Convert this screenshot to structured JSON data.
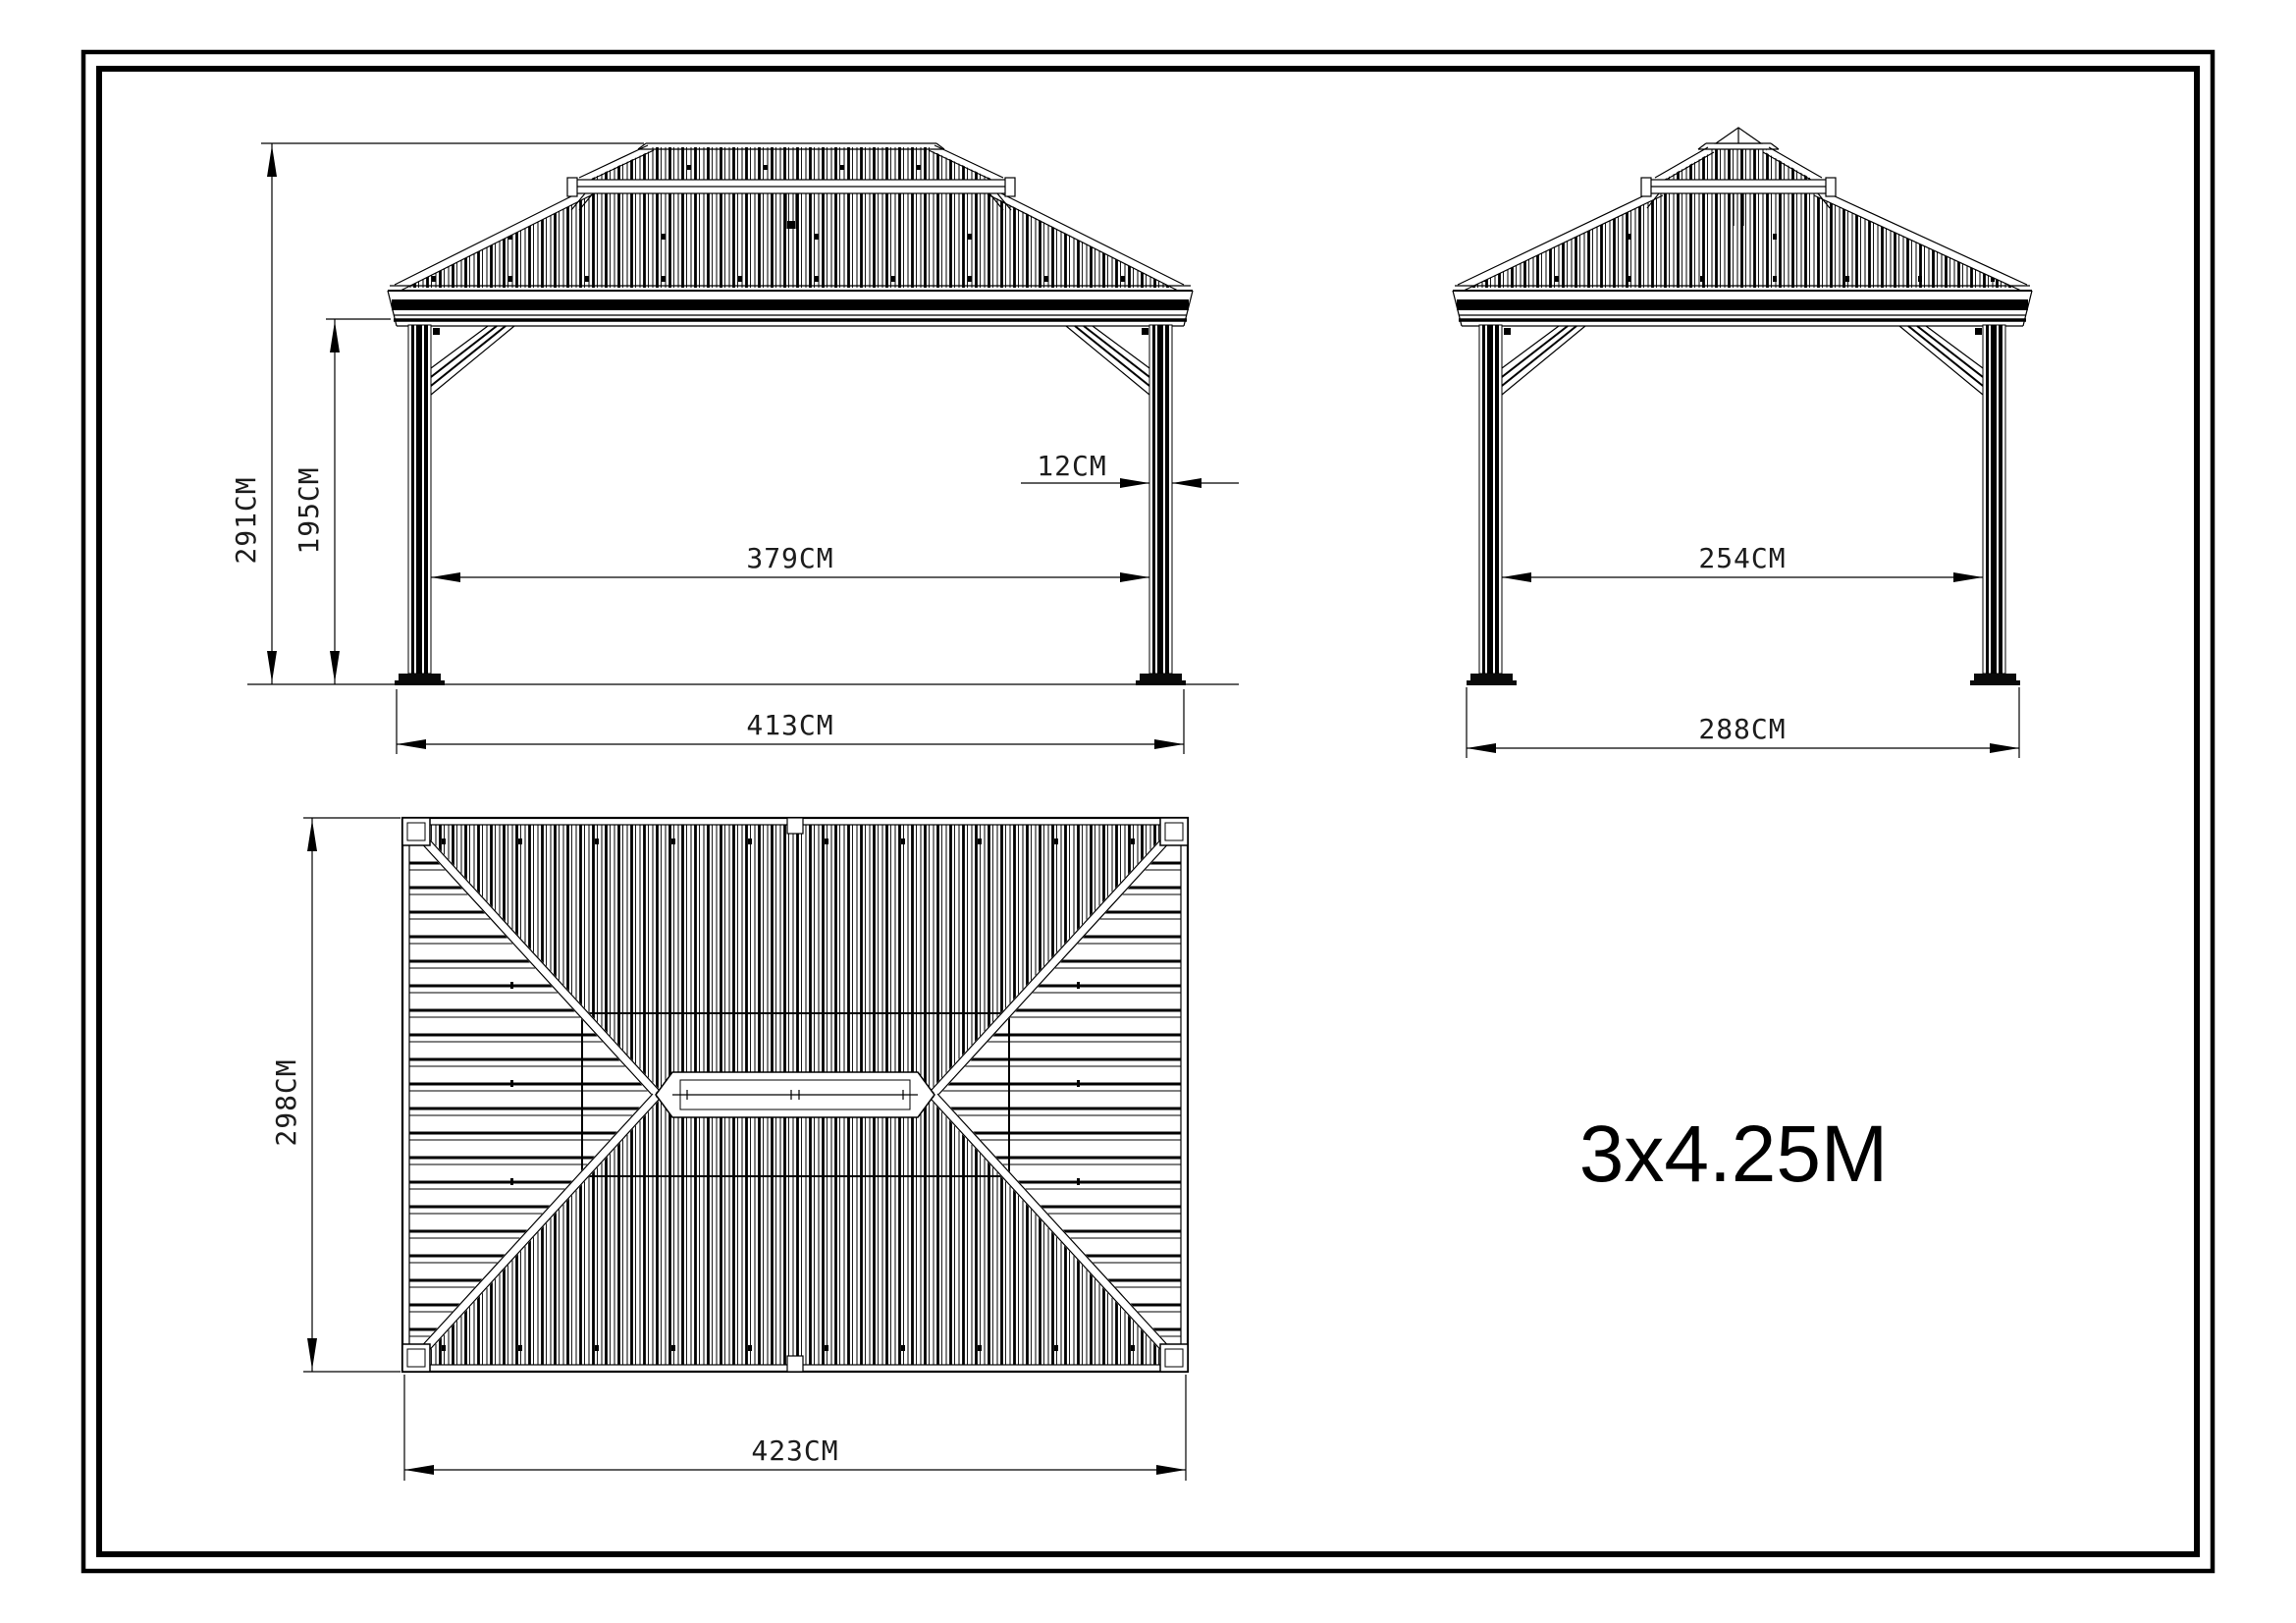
{
  "drawing": {
    "product_size_label": "3x4.25M",
    "front_view": {
      "overall_height": "291CM",
      "eave_height": "195CM",
      "post_width": "12CM",
      "clear_span": "379CM",
      "overall_width": "413CM"
    },
    "side_view": {
      "clear_span": "254CM",
      "overall_width": "288CM"
    },
    "top_view": {
      "overall_depth": "298CM",
      "overall_width": "423CM"
    }
  }
}
